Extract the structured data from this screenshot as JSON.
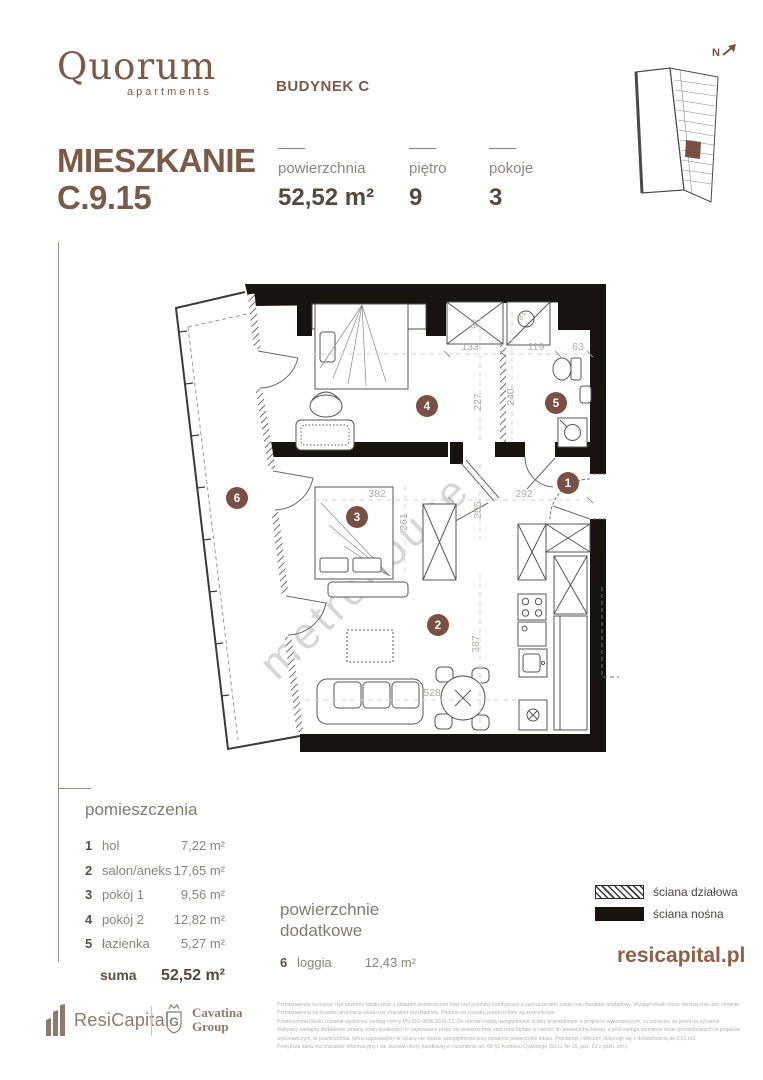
{
  "colors": {
    "accent_brown": "#7b5a49",
    "badge_brown": "#7b5044",
    "wall_black": "#17130f",
    "dim_gray": "#b2aaa2"
  },
  "brand": {
    "logo": "Quorum",
    "logo_sub": "apartments"
  },
  "header": {
    "building": "BUDYNEK C",
    "title_line1": "MIESZKANIE",
    "title_line2": "C.9.15",
    "stats": [
      {
        "label": "powierzchnia",
        "value": "52,52 m²"
      },
      {
        "label": "piętro",
        "value": "9"
      },
      {
        "label": "pokoje",
        "value": "3"
      }
    ],
    "north": "N"
  },
  "plan": {
    "watermark": "metrohouse",
    "badges": {
      "hol": "1",
      "salon": "2",
      "pokoj1": "3",
      "pokoj2": "4",
      "lazienka": "5",
      "loggia": "6"
    },
    "dims": {
      "w133": "133",
      "w119": "119",
      "w63": "63",
      "h227": "227",
      "h240": "240",
      "w90": "90",
      "w81": "81",
      "w382": "382",
      "w292": "292",
      "h205": "205",
      "h261": "261",
      "h387": "387",
      "w528": "528"
    }
  },
  "rooms": {
    "heading": "pomieszczenia",
    "items": [
      {
        "no": "1",
        "name": "hol",
        "area": "7,22 m²"
      },
      {
        "no": "2",
        "name": "salon/aneks",
        "area": "17,65 m²"
      },
      {
        "no": "3",
        "name": "pokój 1",
        "area": "9,56 m²"
      },
      {
        "no": "4",
        "name": "pokój 2",
        "area": "12,82 m²"
      },
      {
        "no": "5",
        "name": "łazienka",
        "area": "5,27 m²"
      }
    ],
    "sum_label": "suma",
    "sum_value": "52,52 m²"
  },
  "additional": {
    "heading_line1": "powierzchnie",
    "heading_line2": "dodatkowe",
    "items": [
      {
        "no": "6",
        "name": "loggia",
        "area": "12,43 m²"
      }
    ]
  },
  "legend": {
    "partition_label": "ściana działowa",
    "bearing_label": "ściana nośna"
  },
  "website": "resicapital.pl",
  "footer": {
    "resicapital": "ResiCapital",
    "cavatina_line1": "Cavatina",
    "cavatina_line2": "Group",
    "cavatina_monogram": "G",
    "disclaimer": [
      "Przedstawiony na karcie rzut poziomy lokalu wraz z układem pomieszczeń oraz rzut poziomy kondygnacji z zaznaczeniem lokalu ma charakter poglądowy. Wygląd lokalu może nieznacznie ulec zmianie.",
      "Przedstawiona na rysunku aranżacja lokalu ma charakter przykładowy. Podane na rysunku powierzchnie są szacunkowe.",
      "Powierzchnia lokalu zostanie wyliczona według normy PN-ISO 9836:2015-12. Do obmiaru będą uwzględnione ściany przewidziane w projekcie wykonawczym, co oznacza, że jeżeli na życzenie",
      "Nabywcy nastąpią dodatkowe zmiany ścian działowych to zajmowana przez nie powierzchnia zaliczona będzie w całości do powierzchni lokalu, a jeśli nastąpi usunięcie ścian przewidzianych w projekcie",
      "wykonawczym, to powierzchnia, którą zajmowałyby te ściany nie będzie uwzględniona przy ustaleniu powierzchni lokalu. Pomiarów i obliczeń dokonuje się z dokładnością do 0,01 m2.",
      "Powyższa karta ma charakter informacyjny i nie stanowi oferty handlowej w rozumieniu art. 66 §1 Kodeksu Cywilnego (Dz.U. Nr 16, poz. 93 z późn. zm.)."
    ]
  }
}
